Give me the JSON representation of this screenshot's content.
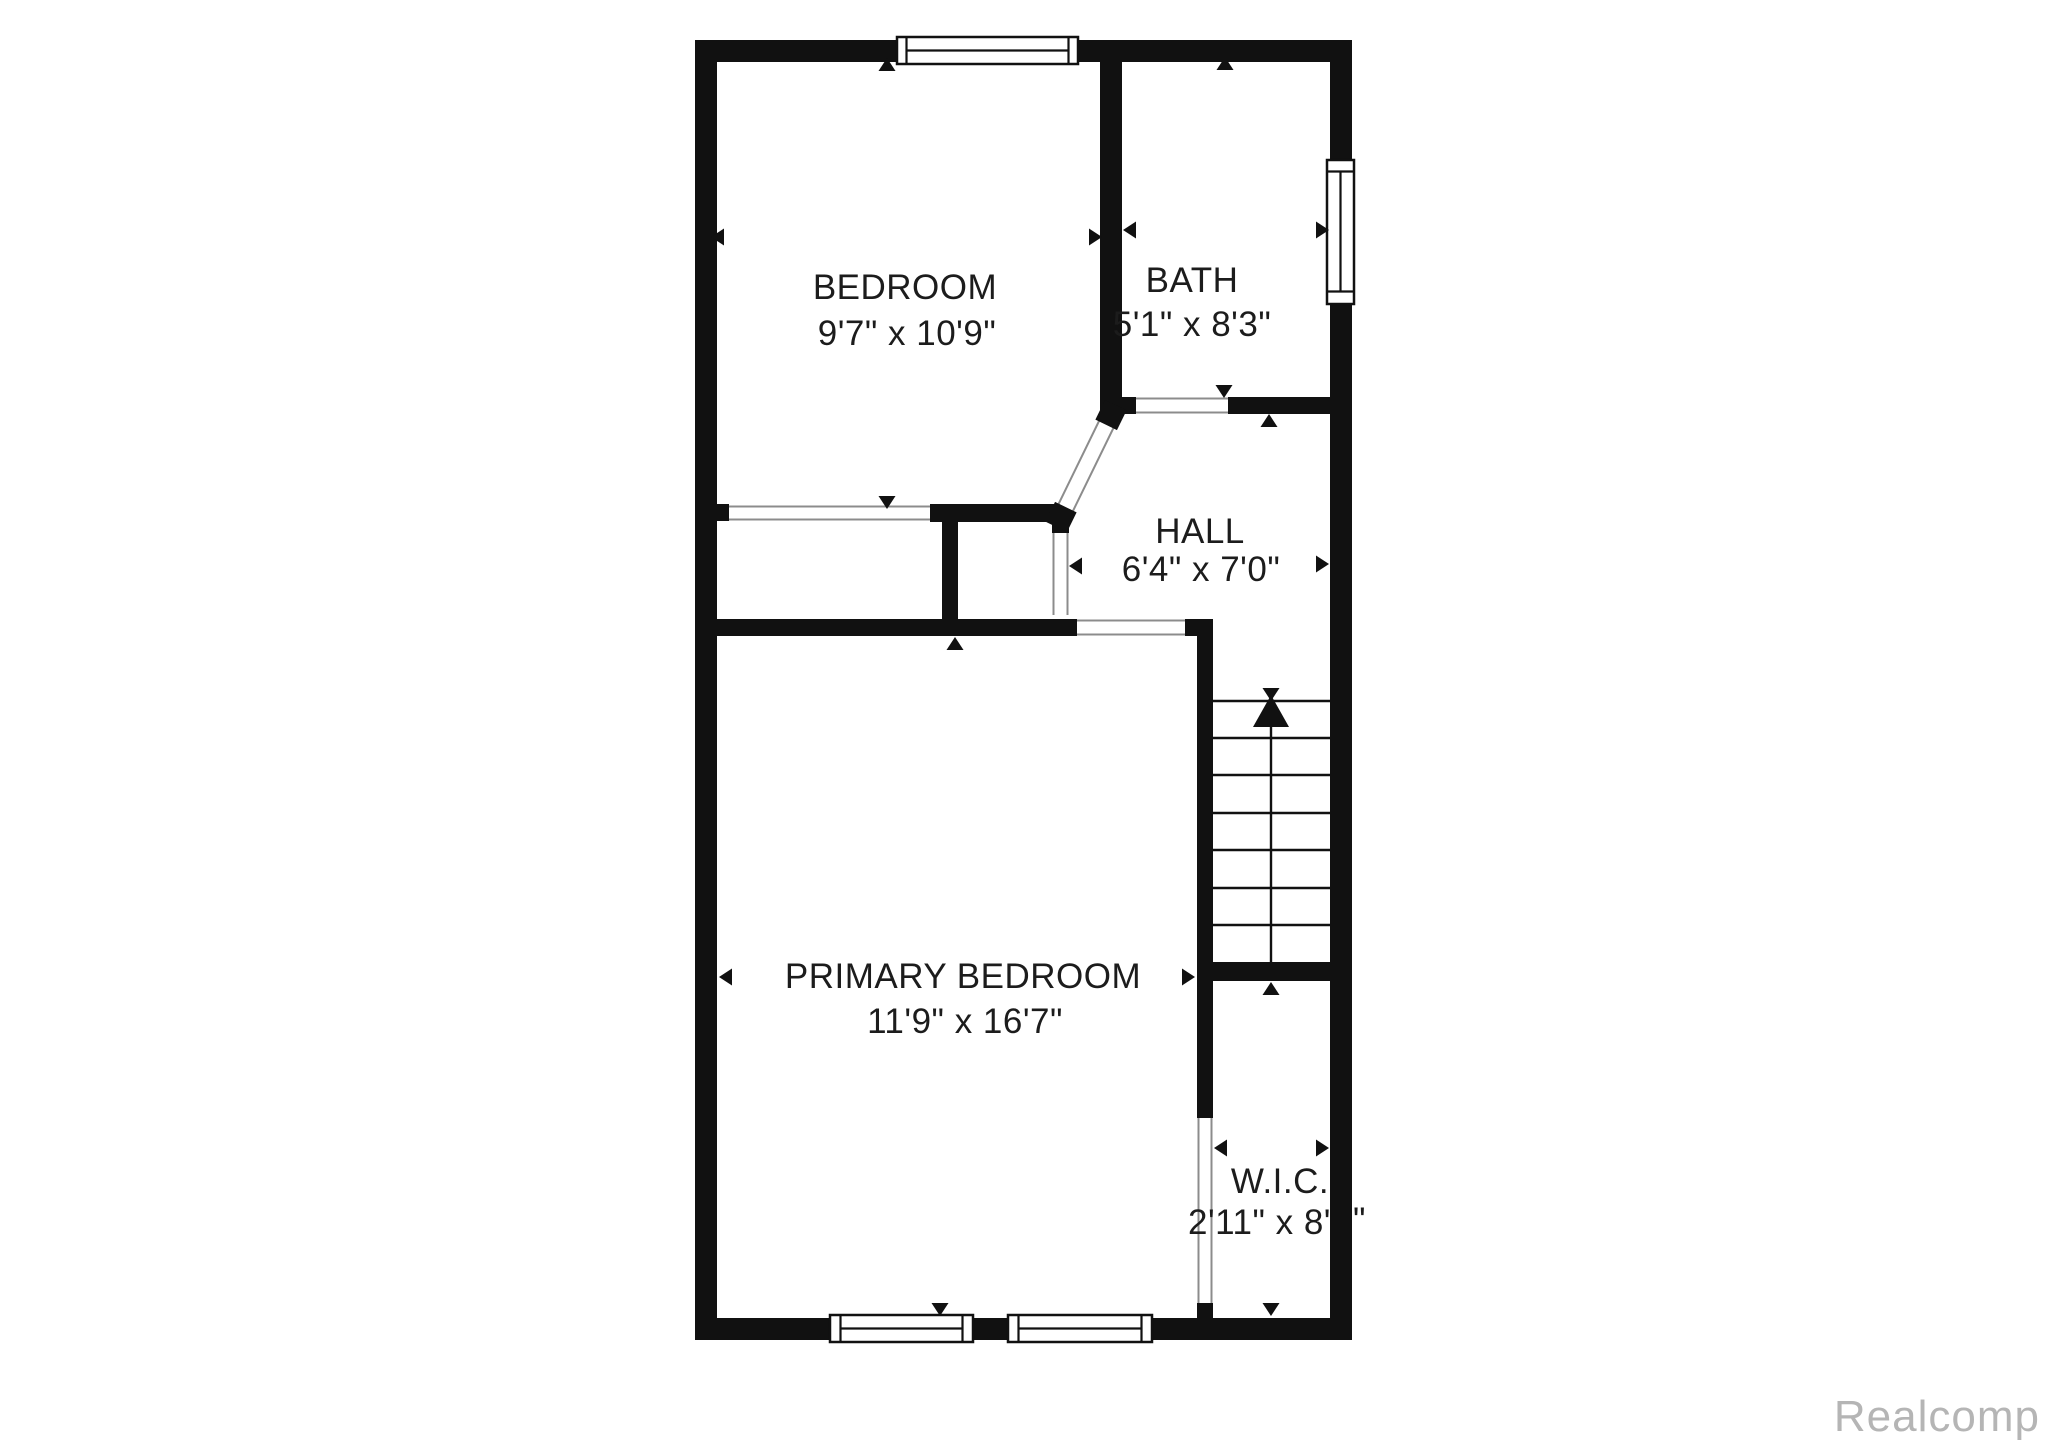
{
  "floor_plan": {
    "rooms": [
      {
        "name": "BEDROOM",
        "dims": "9'7\" x 10'9\""
      },
      {
        "name": "BATH",
        "dims": "5'1\" x 8'3\""
      },
      {
        "name": "HALL",
        "dims": "6'4\" x 7'0\""
      },
      {
        "name": "PRIMARY BEDROOM",
        "dims": "11'9\" x 16'7\""
      },
      {
        "name": "W.I.C.",
        "dims_visible": "2'11\" x 8'",
        "dims_clipped": "\""
      }
    ],
    "stairs": {
      "treads": 7,
      "direction": "up"
    },
    "colors": {
      "wall": "#111111",
      "background": "#ffffff",
      "opening_line": "#8c8c8c",
      "label_text": "#1c1c1c",
      "watermark": "#b5b5b5"
    },
    "watermark": "Realcomp"
  }
}
